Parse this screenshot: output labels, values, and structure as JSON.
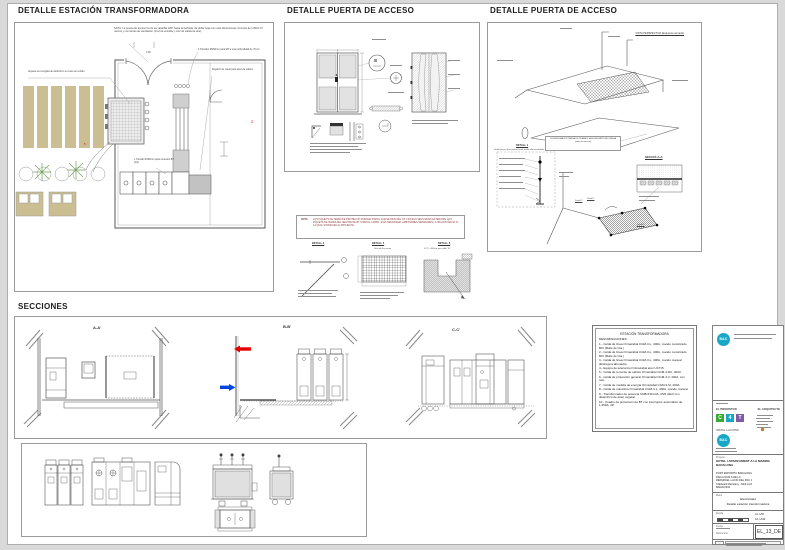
{
  "colors": {
    "tan_louver": "#cbbe92",
    "plant_green": "#76a05d",
    "logo_teal": "#18a7c4",
    "logo_green": "#3aaa35",
    "logo_purple": "#7b5ca5",
    "arrow_red": "#e60000",
    "arrow_blue": "#0047e0"
  },
  "page": {
    "panel1_title": "DETALLE ESTACIÓN TRANSFORMADORA",
    "panel2_title": "DETALLE PUERTA DE ACCESO",
    "panel3_title": "DETALLE PUERTA DE ACCESO",
    "panel4_title": "SECCIONES"
  },
  "trafo": {
    "note_door": "NOTA: La puerta de acceso ha de ser abatible 180º hacia la fachada, de doble hoja con unas dimensiones mínimas de 1,80x2,70 metros y con lamas de ventilación (1m2 de entrada y 1m2 de salida de aire).",
    "note_mt": "4 Tubulars Ø160mm para MT a una profundidad de 70 cm.",
    "note_registre": "Registro de canal para paso de cables",
    "note_reixa": "Arqueta de recogida de dieléctrico en caso de vertido",
    "note_bt": "1 Tubular Ø160mm para conexión BT (tub)",
    "dim_door": "1,80",
    "rev2": "2",
    "rev5": "5"
  },
  "door2": {
    "vista": "VISTA PERSPECTIVA (Esquema armado)",
    "config": "CONFIGURACIÓ PRESA DE TERRES SEGONS MÈTODE UNESA (vista en secció)",
    "detall1": "DETALL 1",
    "detall1_caption": "Detall presa terra (armat) amb malla electrosoldada",
    "seccio": "SECCIÓ A-A",
    "ref1": "Detall 1",
    "ref2": "Detall 2",
    "ref3": "Detall 3"
  },
  "midnotes": {
    "label": "NOTA:",
    "text": "LOS PIQUETS DE TERRA DE PROTECCIÓ PODRAN INSTAL·LAR-SE DINS DEL CT O EN ELS SEUS MURS EXTERIORS. ELS PIQUETS DE TERRA DEL NEUTRE DE BT S'INSTAL·LARAN, SI ÉS NECESSARI, AMB TERRES SEPARADES I A UNA DISTÀNCIA 'D' LA QUAL S'INDICARÀ AL PROJECTE.",
    "detall4": "DETALL 4",
    "detall5": "DETALL 5",
    "detall5_caption": "Unió de les terres",
    "detall6": "DETALL 6",
    "detall6_caption": "S.T.C. 400cm per cable 'W'"
  },
  "sections": {
    "a": "A-A'",
    "b": "B-B'",
    "c": "C-C'"
  },
  "legend": {
    "title": "ESTACIÓN TRANSFORMADORA",
    "subtitle": "DENOMINACIONES:",
    "items": [
      "1.- Celda de línea Ormazabal CGM-3-L, 400A, mando motorizado BCI (Buits de Cia.)",
      "2.- Celda de línea Ormazabal CGM-3-L, 400A, mando motorizado BCI (Buits de Cia.)",
      "3.- Celda de línea Ormazabal CGM-3-L, 400A, mando manual (Entrega a abonado).",
      "4.- Equipo de telecontrol Ormazabal ekor UCT-B.",
      "5.- Celda de remonte de cables Ormazabal CGM-3-RC, 400A.",
      "6.- Celda de protección general Ormazabal CGM-3-V, 400A, con relé.",
      "7.- Celda de medida de energía Ormazabal CGM-3-M, 400A.",
      "8.- Celda de maniobra Ormazabal CGM-3-L, 400A, mando manual.",
      "9.- Transformador de potencia UMB 630 kVA, 25/0,42kV con dieléctrico de éster vegetal.",
      "10.- Cuadro de protección de BT con interruptor automático de 1.250A, 4P."
    ]
  },
  "tb": {
    "logo_text": "BAC",
    "promotor_label": "EL PROMOTOR",
    "arquitecte_label": "EL ARQUITECTE",
    "logo_c": "C",
    "logo_4": "4",
    "logo_t": "T",
    "installacions_label": "INSTAL·LACIONS",
    "projecte_label": "Projecte",
    "project_title": "HOTEL I APARCAMENT A LA MARINA BADALONA",
    "address_1": "PORT ESPORTIU BADALONA",
    "address_2": "FINCA NUM 6 DE LA",
    "address_3": "REPARCEL·LACIÓ DEL PAU 1",
    "address_4": "C/Eduard Maristany - Moll nord",
    "address_5": "BADALONA",
    "plano_label": "Plano",
    "plano_line1": "Electricidad",
    "plano_line2": "Detalle estación transformadora",
    "escala_label": "Escala",
    "escala_a1": "A1: 1/50",
    "escala_a3": "A3: 1/100",
    "fecha_label": "Fecha",
    "referencia_label": "Referencia",
    "drawing_number": "EL_13_DE",
    "stamp_letter": "C"
  }
}
